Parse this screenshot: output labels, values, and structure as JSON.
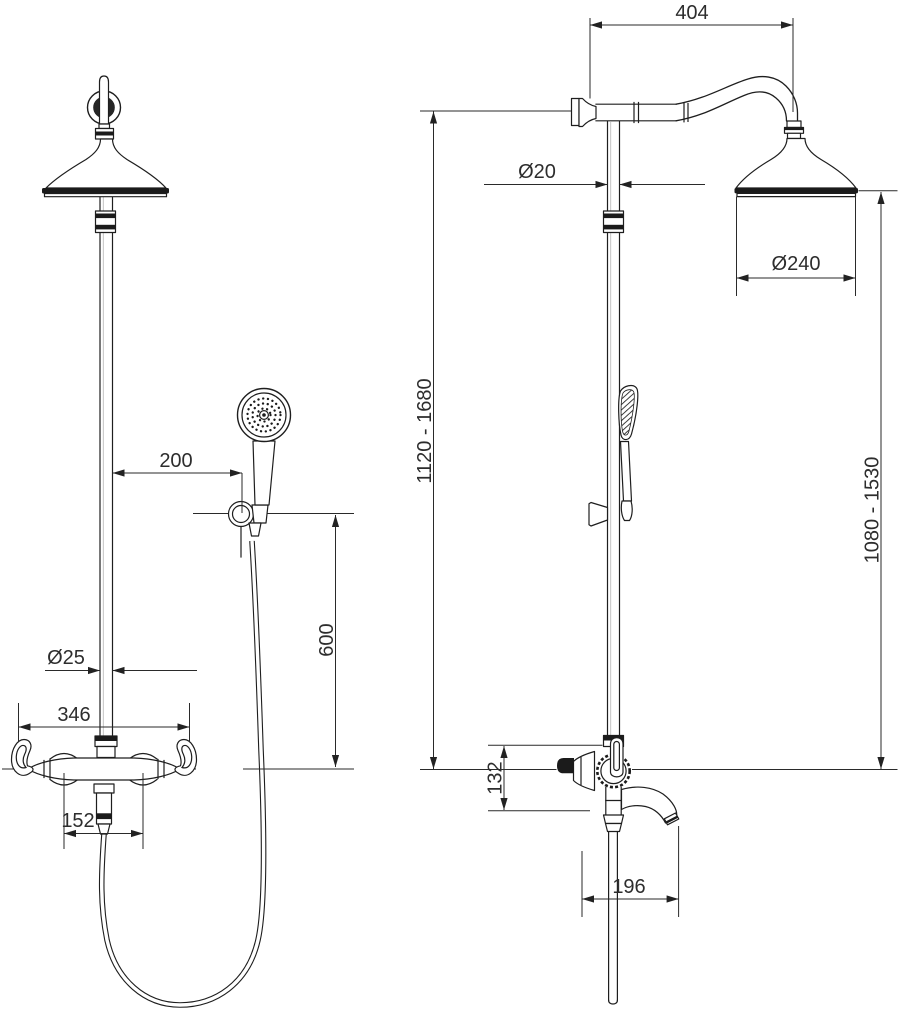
{
  "meta": {
    "drawing_type": "technical dimension drawing",
    "product": "shower column with overhead shower, hand shower and bath mixer",
    "views": {
      "left": "front view",
      "right": "side view"
    },
    "units": "mm"
  },
  "dimensions": {
    "front": {
      "hand_shower_offset": "200",
      "hose_drop_height": "600",
      "riser_pipe_diameter": "Ø25",
      "mixer_body_width": "346",
      "valve_spacing": "152"
    },
    "side": {
      "arm_projection": "404",
      "riser_pipe_diameter": "Ø20",
      "head_diameter": "Ø240",
      "overall_height_range": "1120 - 1680",
      "head_height_range": "1080 - 1530",
      "valve_block_height": "132",
      "spout_projection": "196"
    }
  },
  "colors": {
    "line": "#1e1e1e",
    "dimension_text": "#2d2d2d",
    "background": "#ffffff",
    "solid_fill": "#1b1b1b"
  }
}
